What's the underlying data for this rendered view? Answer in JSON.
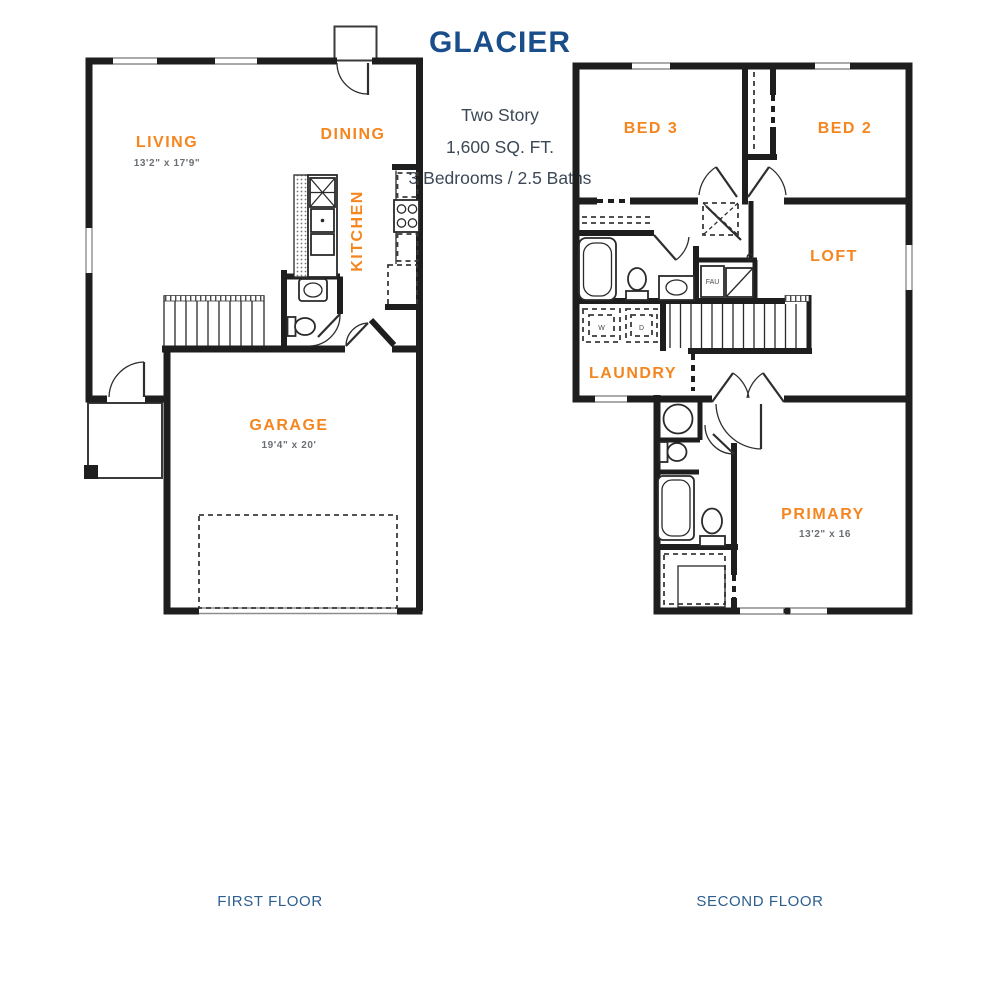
{
  "header": {
    "title": "GLACIER",
    "subtitle": [
      "Two Story",
      "1,600 SQ. FT.",
      "3 Bedrooms / 2.5 Baths"
    ]
  },
  "colors": {
    "accent_orange": "#F5861F",
    "heading_blue": "#1A4E8A",
    "caption_blue": "#2D5E8E",
    "wall_black": "#1E1E1E",
    "dim_gray": "#6B6F73"
  },
  "first_floor": {
    "caption": "FIRST FLOOR",
    "living": {
      "label": "LIVING",
      "dims": "13'2\" x 17'9\""
    },
    "dining": {
      "label": "DINING"
    },
    "kitchen": {
      "label": "KITCHEN"
    },
    "garage": {
      "label": "GARAGE",
      "dims": "19'4\" x 20'"
    }
  },
  "second_floor": {
    "caption": "SECOND FLOOR",
    "bed3": {
      "label": "BED 3"
    },
    "bed2": {
      "label": "BED 2"
    },
    "loft": {
      "label": "LOFT"
    },
    "laundry": {
      "label": "LAUNDRY"
    },
    "primary": {
      "label": "PRIMARY",
      "dims": "13'2\" x 16"
    },
    "washer": "W",
    "dryer": "D",
    "fau": "FAU"
  }
}
